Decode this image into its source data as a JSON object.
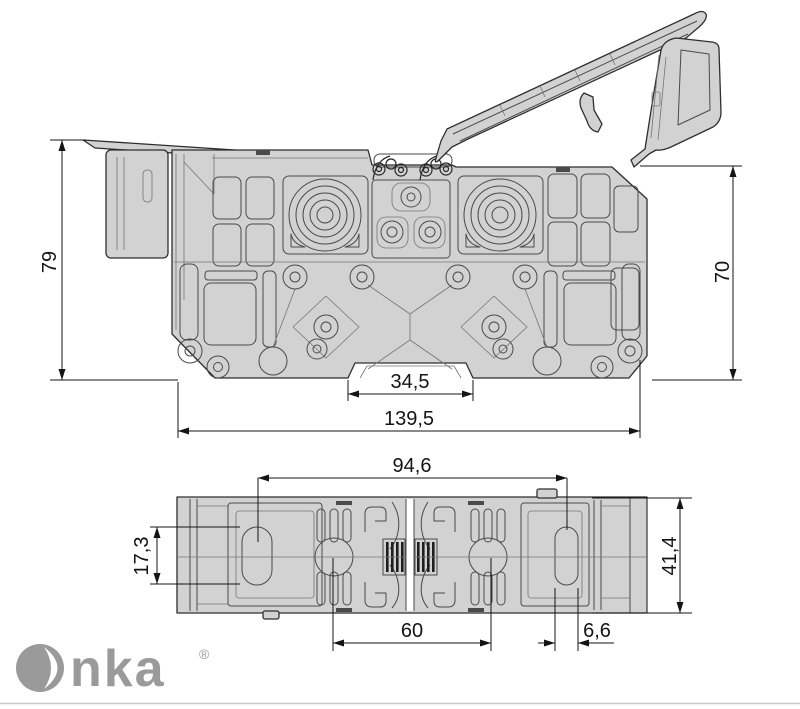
{
  "brand": {
    "name": "Onka",
    "registered": "®"
  },
  "colors": {
    "body_fill": "#d2d2d2",
    "outline": "#2e2e2e",
    "inner_line": "#4a4a4a",
    "dimension": "#141414",
    "logo": "#9a9a9a"
  },
  "dimensions": {
    "front_height_left": "79",
    "front_height_right": "70",
    "rail_notch_width": "34,5",
    "overall_width": "139,5",
    "top_span": "94,6",
    "mount_slot_height": "17,3",
    "overall_depth": "41,4",
    "contact_spacing": "60",
    "mount_slot_width": "6,6"
  }
}
